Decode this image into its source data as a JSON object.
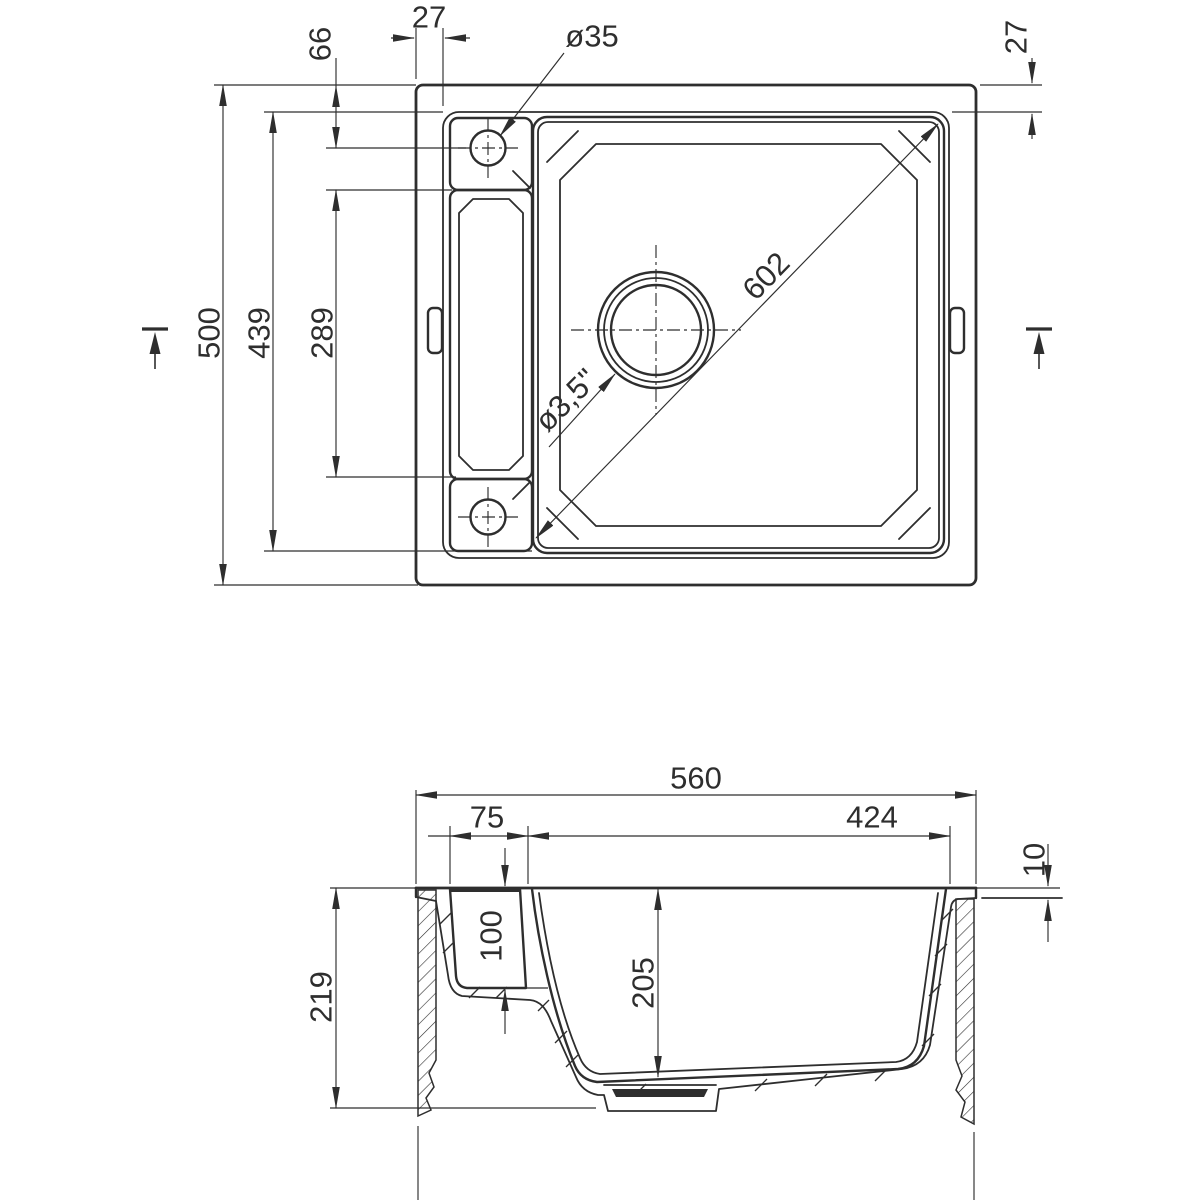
{
  "title": "Sink technical drawing, two views",
  "colors": {
    "line": "#2e2e2e",
    "background": "#ffffff"
  },
  "top_view": {
    "dim_rim_offset_left": "27",
    "dim_hole_offset": "66",
    "dim_faucet_hole": "ø35",
    "dim_rim_offset_right": "27",
    "dim_overall_height": "500",
    "dim_inner_height": "439",
    "dim_tray_length": "289",
    "dim_bowl_diagonal": "602",
    "dim_drain": "ø3,5\""
  },
  "section_view": {
    "dim_overall_width": "560",
    "dim_tray_width": "75",
    "dim_bowl_width": "424",
    "dim_rim_height": "10",
    "dim_tray_depth": "100",
    "dim_total_depth": "219",
    "dim_bowl_depth": "205",
    "dim_cabinet_width": "600"
  }
}
